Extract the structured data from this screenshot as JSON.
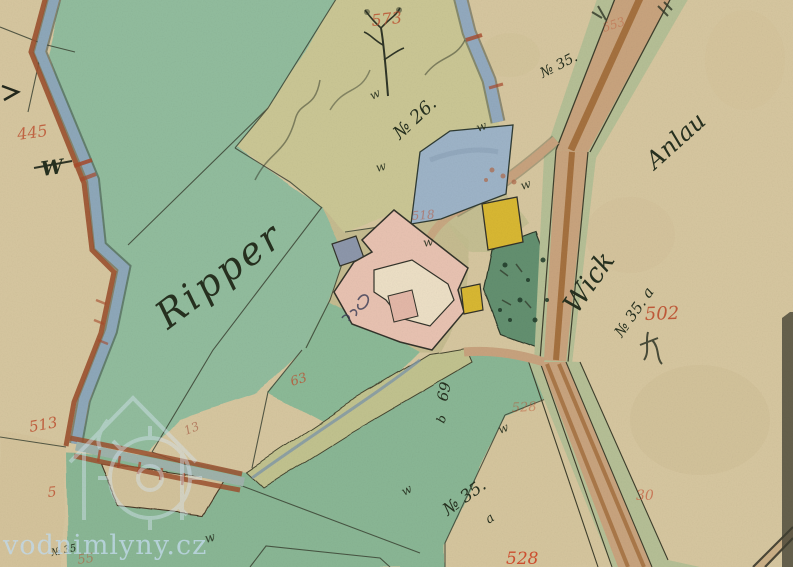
{
  "map_labels": {
    "ripper": "Ripper",
    "no26": "№ 26.",
    "no35_top": "№ 35.",
    "wick": "Wick",
    "anlau": "Anlau",
    "no35_right": "№ 35. a",
    "no35_bottom": "№ 35.",
    "no35_bottom_suffix": "a",
    "no35_small": "№ 35",
    "n69": "69",
    "n69_suffix": "b",
    "w_mark": "w",
    "w_large": "W"
  },
  "parcel_numbers": {
    "p573": "573",
    "p553": "553",
    "p502": "502",
    "p513": "513",
    "p445": "445",
    "p63": "63",
    "p518": "518",
    "p528_upper": "528",
    "p528_lower": "528",
    "p30": "30",
    "p5": "5",
    "p13": "13",
    "p55": "55"
  },
  "watermark": {
    "text": "vodnimlyny.cz"
  },
  "palette": {
    "paper": "#d7c7a0",
    "field_green": "#92bd9e",
    "meadow_green": "#8ab795",
    "olive_field": "#cbc795",
    "garden_green": "#649070",
    "water_blue": "#8ea8ba",
    "pond_blue": "#9eb4c8",
    "bank_brown": "#9c512f",
    "road_tan": "#c9a47e",
    "road_brown": "#a5713f",
    "verge_green": "#b6c096",
    "building_pink": "#e9c3b2",
    "building_yellow": "#d9b832",
    "building_gray": "#8d97ab",
    "courtyard_cream": "#ede0c6",
    "ink_black": "#2e3326",
    "ink_red": "#bf4e2e",
    "watermark_blue": "#c3dced"
  }
}
